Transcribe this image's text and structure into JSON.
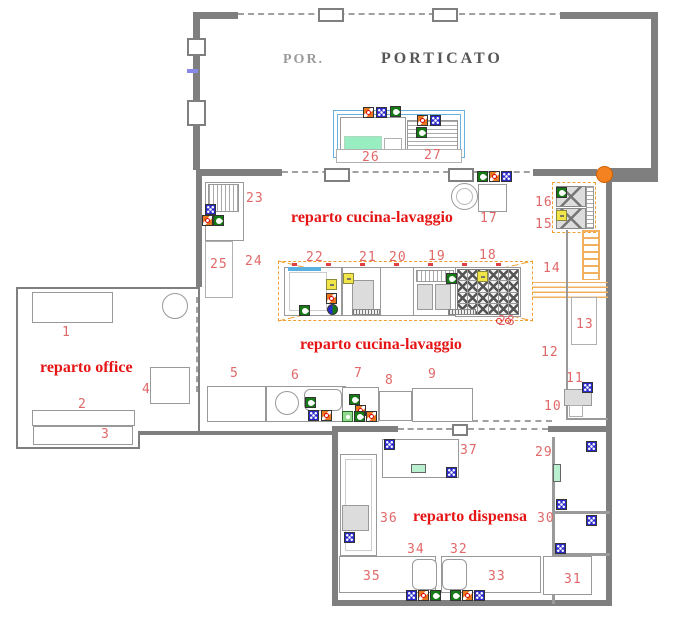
{
  "rooms": {
    "porticato_label": "PORTICATO",
    "porticato_ghost": "POR.",
    "cucina_upper": "reparto cucina-lavaggio",
    "cucina_lower": "reparto cucina-lavaggio",
    "office": "reparto office",
    "dispensa": "reparto dispensa"
  },
  "colors": {
    "wall_gray": "#7f7f7f",
    "equipment_gray": "#b0b0b0",
    "label_red": "#e06868",
    "room_name_red": "#e51515",
    "hood_orange": "#f0a030",
    "duct_orange": "#f0b060",
    "junction_orange": "#f58220",
    "water_blue": "#6ab0dc",
    "green_fill": "#98eec0",
    "icon_blue": "#2a2acd",
    "icon_green": "#157a15",
    "icon_orange": "#e87820",
    "icon_yellow": "#f2e54a"
  },
  "item_labels": [
    {
      "n": "1",
      "x": 62,
      "y": 325
    },
    {
      "n": "2",
      "x": 78,
      "y": 397
    },
    {
      "n": "3",
      "x": 101,
      "y": 427
    },
    {
      "n": "4",
      "x": 142,
      "y": 382
    },
    {
      "n": "5",
      "x": 230,
      "y": 366
    },
    {
      "n": "6",
      "x": 291,
      "y": 368
    },
    {
      "n": "7",
      "x": 354,
      "y": 366
    },
    {
      "n": "8",
      "x": 385,
      "y": 373
    },
    {
      "n": "9",
      "x": 428,
      "y": 367
    },
    {
      "n": "10",
      "x": 544,
      "y": 399
    },
    {
      "n": "11",
      "x": 566,
      "y": 371
    },
    {
      "n": "12",
      "x": 541,
      "y": 345
    },
    {
      "n": "13",
      "x": 576,
      "y": 317
    },
    {
      "n": "14",
      "x": 543,
      "y": 261
    },
    {
      "n": "15",
      "x": 535,
      "y": 217
    },
    {
      "n": "16",
      "x": 535,
      "y": 195
    },
    {
      "n": "17",
      "x": 480,
      "y": 211
    },
    {
      "n": "18",
      "x": 479,
      "y": 248
    },
    {
      "n": "19",
      "x": 428,
      "y": 249
    },
    {
      "n": "20",
      "x": 389,
      "y": 250
    },
    {
      "n": "21",
      "x": 359,
      "y": 250
    },
    {
      "n": "22",
      "x": 306,
      "y": 250
    },
    {
      "n": "23",
      "x": 246,
      "y": 191
    },
    {
      "n": "24",
      "x": 245,
      "y": 254
    },
    {
      "n": "25",
      "x": 210,
      "y": 257
    },
    {
      "n": "26",
      "x": 362,
      "y": 150
    },
    {
      "n": "27",
      "x": 424,
      "y": 148
    },
    {
      "n": "28",
      "x": 498,
      "y": 314
    },
    {
      "n": "29",
      "x": 535,
      "y": 445
    },
    {
      "n": "30",
      "x": 537,
      "y": 511
    },
    {
      "n": "31",
      "x": 564,
      "y": 572
    },
    {
      "n": "32",
      "x": 450,
      "y": 542
    },
    {
      "n": "33",
      "x": 488,
      "y": 569
    },
    {
      "n": "34",
      "x": 407,
      "y": 542
    },
    {
      "n": "35",
      "x": 363,
      "y": 569
    },
    {
      "n": "36",
      "x": 380,
      "y": 511
    },
    {
      "n": "37",
      "x": 460,
      "y": 443
    }
  ],
  "icons": [
    {
      "t": "orange",
      "x": 363,
      "y": 107
    },
    {
      "t": "blue",
      "x": 376,
      "y": 107
    },
    {
      "t": "green",
      "x": 390,
      "y": 106
    },
    {
      "t": "orange",
      "x": 417,
      "y": 115
    },
    {
      "t": "blue",
      "x": 430,
      "y": 115
    },
    {
      "t": "green",
      "x": 416,
      "y": 127
    },
    {
      "t": "blue",
      "x": 205,
      "y": 204
    },
    {
      "t": "orange",
      "x": 202,
      "y": 215
    },
    {
      "t": "green",
      "x": 213,
      "y": 215
    },
    {
      "t": "green",
      "x": 477,
      "y": 171
    },
    {
      "t": "orange",
      "x": 489,
      "y": 171
    },
    {
      "t": "blue",
      "x": 501,
      "y": 171
    },
    {
      "t": "green",
      "x": 556,
      "y": 187
    },
    {
      "t": "yellow",
      "x": 556,
      "y": 210
    },
    {
      "t": "yellow",
      "x": 326,
      "y": 279
    },
    {
      "t": "orange",
      "x": 326,
      "y": 293
    },
    {
      "t": "bluegreen",
      "x": 327,
      "y": 304
    },
    {
      "t": "green",
      "x": 299,
      "y": 305
    },
    {
      "t": "yellow",
      "x": 343,
      "y": 273
    },
    {
      "t": "green",
      "x": 446,
      "y": 273
    },
    {
      "t": "yellow",
      "x": 477,
      "y": 271
    },
    {
      "t": "green",
      "x": 305,
      "y": 397
    },
    {
      "t": "blue",
      "x": 308,
      "y": 410
    },
    {
      "t": "orange",
      "x": 321,
      "y": 410
    },
    {
      "t": "green",
      "x": 349,
      "y": 394
    },
    {
      "t": "orange",
      "x": 355,
      "y": 405
    },
    {
      "t": "lightgreen",
      "x": 342,
      "y": 411
    },
    {
      "t": "green",
      "x": 354,
      "y": 411
    },
    {
      "t": "orange",
      "x": 366,
      "y": 411
    },
    {
      "t": "blue",
      "x": 582,
      "y": 382
    },
    {
      "t": "blue",
      "x": 384,
      "y": 439
    },
    {
      "t": "blue",
      "x": 446,
      "y": 467
    },
    {
      "t": "blue",
      "x": 586,
      "y": 441
    },
    {
      "t": "blue",
      "x": 556,
      "y": 499
    },
    {
      "t": "blue",
      "x": 586,
      "y": 515
    },
    {
      "t": "blue",
      "x": 555,
      "y": 543
    },
    {
      "t": "blue",
      "x": 344,
      "y": 532
    },
    {
      "t": "blue",
      "x": 406,
      "y": 590
    },
    {
      "t": "orange",
      "x": 418,
      "y": 590
    },
    {
      "t": "green",
      "x": 430,
      "y": 590
    },
    {
      "t": "green",
      "x": 450,
      "y": 590
    },
    {
      "t": "orange",
      "x": 462,
      "y": 590
    },
    {
      "t": "blue",
      "x": 474,
      "y": 590
    }
  ],
  "burner_grid": {
    "rows": 4,
    "cols": 6
  }
}
